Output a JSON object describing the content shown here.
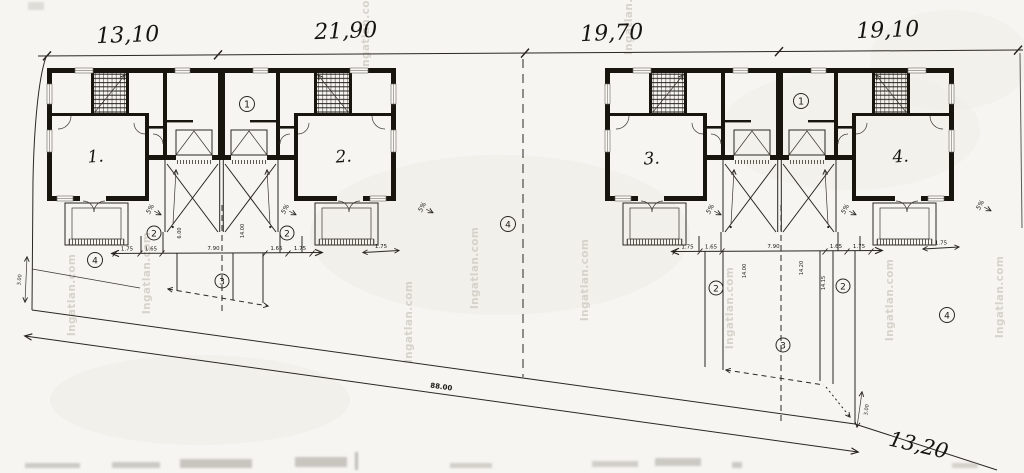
{
  "watermark": {
    "text": "Ingatlan.com"
  },
  "units": {
    "labels": [
      "1.",
      "2.",
      "3.",
      "4."
    ]
  },
  "dimensions": {
    "top": [
      "13,10",
      "21,90",
      "19,70",
      "19,10"
    ],
    "road_total": "88.00",
    "road_corner": "13,20",
    "strip_widths": [
      "1.75",
      "1.65",
      "7.90",
      "1.65",
      "1.75"
    ],
    "side_strip": "1.75",
    "edge_setback": "3.00",
    "driveway_lengths_left": [
      "6.00",
      "14.00"
    ],
    "driveway_lengths_right": [
      "14.00",
      "14.20",
      "14.15"
    ],
    "slope": "5%"
  },
  "legend_markers": {
    "one": "1",
    "two": "2",
    "three": "3",
    "four": "4"
  }
}
